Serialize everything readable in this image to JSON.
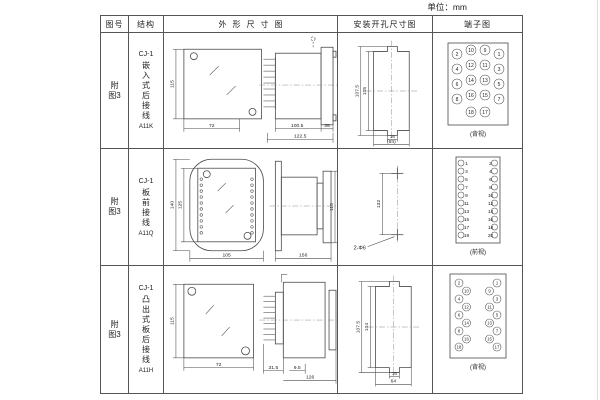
{
  "unit_label": "单位：mm",
  "header": {
    "fig": "图号",
    "struct": "结构",
    "outline": "外形尺寸图",
    "mount": "安装开孔尺寸图",
    "terminal": "端子图"
  },
  "rows": [
    {
      "fig": "附图3",
      "struct": {
        "model": "CJ-1",
        "desc": "嵌入式后接线",
        "code": "A11K"
      },
      "outline": {
        "front_h": "115",
        "front_w": "72",
        "body_len": "100.5",
        "total_len": "122.5",
        "flange": "35"
      },
      "mount": {
        "v_outer": "107.5",
        "v_inner": "105",
        "notch": "16",
        "width": "(64)"
      },
      "terminal": {
        "style": "back-grid",
        "caption": "(背视)",
        "grid": [
          [
            "2",
            "10",
            "9",
            "1"
          ],
          [
            "4",
            "12",
            "11",
            "3"
          ],
          [
            "6",
            "14",
            "13",
            "5"
          ],
          [
            "8",
            "16",
            "15",
            "7"
          ]
        ],
        "last": [
          "18",
          "17"
        ]
      }
    },
    {
      "fig": "附图3",
      "struct": {
        "model": "CJ-1",
        "desc": "板前接线",
        "code": "A11Q"
      },
      "outline": {
        "front_h_outer": "140",
        "front_h_inner": "125",
        "front_w": "105",
        "side_len": "156",
        "side_h": "115"
      },
      "mount": {
        "v": "132",
        "holes": "2-Φ6"
      },
      "terminal": {
        "style": "front-columns",
        "caption": "(前视)",
        "left": [
          "1",
          "3",
          "5",
          "7",
          "9",
          "11",
          "13",
          "15",
          "17",
          "19"
        ],
        "right": [
          "2",
          "4",
          "6",
          "8",
          "10",
          "12",
          "14",
          "16",
          "18",
          "20"
        ]
      }
    },
    {
      "fig": "附图3",
      "struct": {
        "model": "CJ-1",
        "desc": "凸出式板后接线",
        "code": "A11H"
      },
      "outline": {
        "front_h": "115",
        "front_w": "72",
        "pin_len": "31.5",
        "flange_t": "9.5",
        "total_len": "126"
      },
      "mount": {
        "v_outer": "107.5",
        "v_inner": "104",
        "notch": "16",
        "width": "64"
      },
      "terminal": {
        "style": "back-zigzag",
        "caption": "(背视)",
        "left": [
          "2",
          "10",
          "4",
          "12",
          "6",
          "14",
          "8",
          "16",
          "18"
        ],
        "right": [
          "1",
          "9",
          "3",
          "11",
          "5",
          "13",
          "7",
          "15",
          "17"
        ]
      }
    }
  ]
}
